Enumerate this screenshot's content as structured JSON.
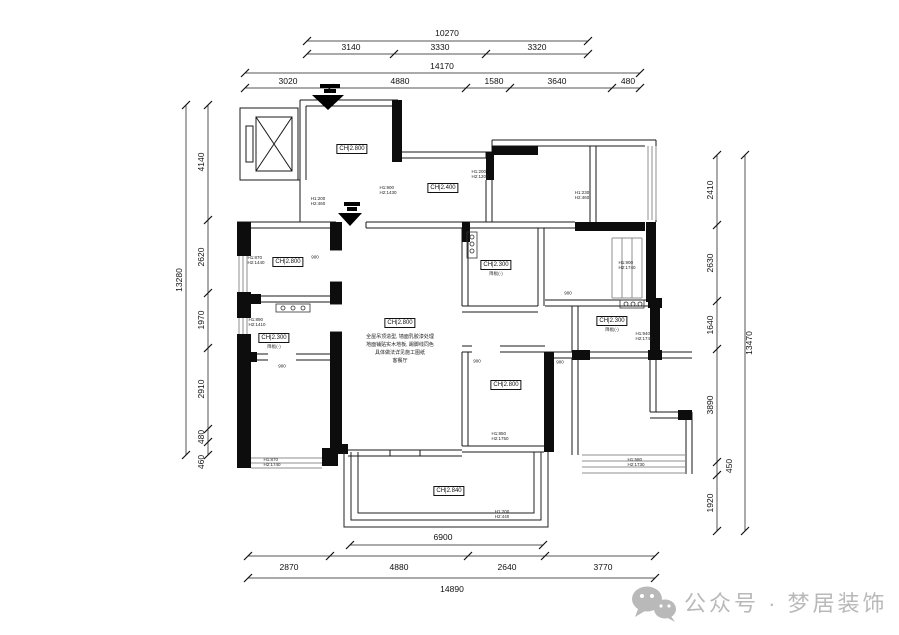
{
  "dims": {
    "top_inner_total": "10270",
    "top_inner": [
      "3140",
      "3330",
      "3320"
    ],
    "top_outer_total": "14170",
    "top_outer": [
      "3020",
      "4880",
      "1580",
      "3640",
      "480"
    ],
    "left_total": "13280",
    "left": [
      "4140",
      "2620",
      "1970",
      "2910",
      "480",
      "460"
    ],
    "right_total": "13470",
    "right": [
      "2410",
      "2630",
      "1640",
      "3890",
      "450",
      "1920"
    ],
    "bottom_balcony": "6900",
    "bottom": [
      "2870",
      "4880",
      "2640",
      "3770"
    ],
    "bottom_total": "14890"
  },
  "rooms": [
    {
      "name": "entry-hall",
      "label": "CH|2.800"
    },
    {
      "name": "kitchen",
      "label": "CH|2.400"
    },
    {
      "name": "living-dining",
      "label": "CH|2.800",
      "notes": "全屋吊顶造型, 墙面乳胶漆处理\n地面铺贴实木地板, 踢脚线同色\n具体做法详见施工图纸\n客餐厅"
    },
    {
      "name": "bedroom-left-middle",
      "label": "CH|2.800"
    },
    {
      "name": "bedroom-left-lower",
      "label": "CH|2.300",
      "sub": "降板(-)"
    },
    {
      "name": "study-middle",
      "label": "CH|2.300",
      "sub": "降板(-)"
    },
    {
      "name": "bedroom-right",
      "label": "CH|2.300",
      "sub": "降板(-)"
    },
    {
      "name": "bedroom-bottom-middle",
      "label": "CH|2.800"
    },
    {
      "name": "balcony",
      "label": "CH|2.840"
    }
  ],
  "annotations": [
    "H1:200\nH2:460",
    "H1:900\nH2:1430",
    "H1:200\nH2:1200",
    "H1:230\nH2:460",
    "H1:900\nH2:1740",
    "H1:870\nH2:1440",
    "H1:890\nH2:1410",
    "H1:870\nH2:1740",
    "H1:940\nH2:1740",
    "H1:850\nH2:1750",
    "H1:580\nH2:1730",
    "H1:200\nH2:440"
  ],
  "door_widths": [
    "900",
    "900",
    "900",
    "900",
    "900"
  ],
  "watermark": {
    "text": "公众号 · 梦居装饰",
    "color": "#b9b9b9"
  }
}
